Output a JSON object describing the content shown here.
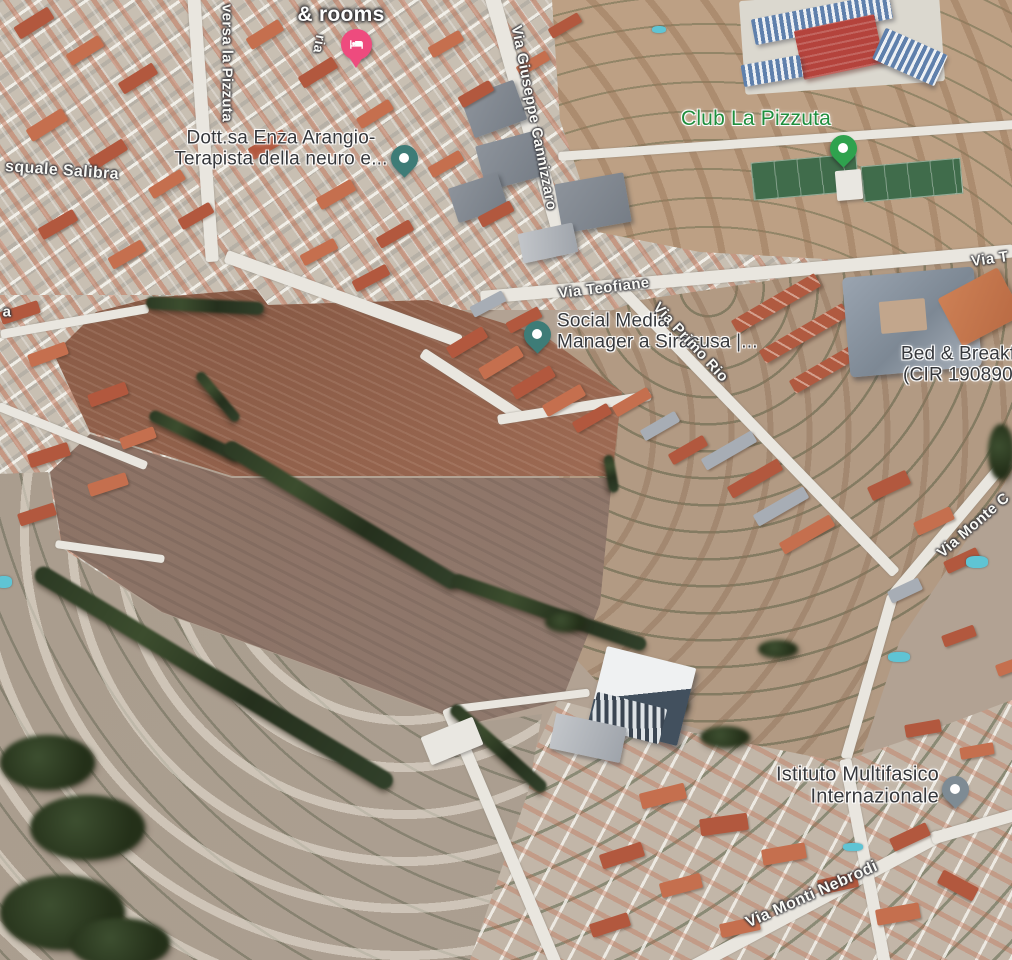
{
  "app": {
    "view": "satellite-map",
    "description": "Aerial 3D satellite map view of the La Pizzuta area, Siracusa"
  },
  "colors": {
    "street_label": "#fafaf6",
    "poi_label_dark": "#35373b",
    "poi_label_green": "#1f8e3d",
    "hotel_pin": "#ee4b7e",
    "teal_pin": "#3e7c77",
    "green_pin": "#2fa24e",
    "gray_pin": "#7e8b94"
  },
  "labels": [
    {
      "id": "hotel-rooms-label",
      "text": "& rooms",
      "style": "hotel",
      "x": 341,
      "y": 15,
      "rot": 0,
      "size": 21,
      "align": "center",
      "interactable": true
    },
    {
      "id": "street-ria",
      "text": "ria",
      "style": "street",
      "x": 319,
      "y": 44,
      "rot": 100,
      "size": 14,
      "align": "center",
      "interactable": false
    },
    {
      "id": "street-traversa-la-pizzuta",
      "text": "versa la Pizzuta",
      "style": "street",
      "x": 226,
      "y": 63,
      "rot": 90,
      "size": 15,
      "align": "center",
      "interactable": false
    },
    {
      "id": "street-pasquale-salibra",
      "text": "squale Salibra",
      "style": "street",
      "x": 62,
      "y": 171,
      "rot": 4,
      "size": 16,
      "align": "center",
      "interactable": false
    },
    {
      "id": "poi-dott-enza-arangio",
      "text": "Dott.sa Enza Arangio-\nTerapista della neuro e...",
      "style": "poi",
      "x": 281,
      "y": 149,
      "rot": 0,
      "size": 19,
      "align": "center",
      "interactable": true
    },
    {
      "id": "street-via-giuseppe-cannizzaro",
      "text": "Via Giuseppe Cannizzaro",
      "style": "street",
      "x": 533,
      "y": 118,
      "rot": 79,
      "size": 15,
      "align": "center",
      "interactable": false
    },
    {
      "id": "poi-club-la-pizzuta",
      "text": "Club La Pizzuta",
      "style": "poi-green",
      "x": 756,
      "y": 119,
      "rot": 0,
      "size": 21,
      "align": "center",
      "interactable": true
    },
    {
      "id": "street-via-t",
      "text": "Via T",
      "style": "street",
      "x": 990,
      "y": 260,
      "rot": -8,
      "size": 15,
      "align": "center",
      "interactable": false
    },
    {
      "id": "street-via-teofiane",
      "text": "Via Teofiane",
      "style": "street",
      "x": 604,
      "y": 289,
      "rot": -7,
      "size": 15,
      "align": "center",
      "interactable": false
    },
    {
      "id": "poi-social-media-manager",
      "text": "Social Media\nManager a Siracusa |...",
      "style": "poi",
      "x": 557,
      "y": 332,
      "rot": 0,
      "size": 19,
      "align": "left",
      "interactable": true
    },
    {
      "id": "street-via-primo-rio",
      "text": "Via Primo Rio",
      "style": "street",
      "x": 690,
      "y": 343,
      "rot": 47,
      "size": 15,
      "align": "center",
      "interactable": false
    },
    {
      "id": "poi-bed-and-breakfast",
      "text": "Bed & Breakf\n(CIR 190890",
      "style": "poi",
      "x": 958,
      "y": 365,
      "rot": 0,
      "size": 19,
      "align": "center",
      "interactable": true
    },
    {
      "id": "street-via-monte-c",
      "text": "Via Monte C",
      "style": "street",
      "x": 974,
      "y": 526,
      "rot": -41,
      "size": 15,
      "align": "center",
      "interactable": false
    },
    {
      "id": "poi-istituto-multifasico",
      "text": "Istituto Multifasico\nInternazionale",
      "style": "poi",
      "x": 939,
      "y": 786,
      "rot": 0,
      "size": 20,
      "align": "right",
      "interactable": true
    },
    {
      "id": "street-via-monti-nebrodi",
      "text": "Via Monti Nebrodi",
      "style": "street",
      "x": 812,
      "y": 895,
      "rot": -24,
      "size": 16,
      "align": "center",
      "interactable": false
    },
    {
      "id": "street-partial-a",
      "text": "a",
      "style": "street",
      "x": 7,
      "y": 313,
      "rot": 0,
      "size": 15,
      "align": "center",
      "interactable": false
    }
  ],
  "pins": [
    {
      "id": "hotel-pin",
      "kind": "hotel",
      "icon": "bed-icon",
      "color": "#ee4b7e",
      "tip_x": 356,
      "tip_y": 68
    },
    {
      "id": "dott-enza-arangio-pin",
      "kind": "teardrop",
      "icon": "dot",
      "color": "#3e7c77",
      "tip_x": 404,
      "tip_y": 177
    },
    {
      "id": "club-la-pizzuta-pin",
      "kind": "teardrop",
      "icon": "dot",
      "color": "#2fa24e",
      "tip_x": 843,
      "tip_y": 167
    },
    {
      "id": "social-media-manager-pin",
      "kind": "teardrop",
      "icon": "dot",
      "color": "#3e7c77",
      "tip_x": 537,
      "tip_y": 353
    },
    {
      "id": "istituto-multifasico-pin",
      "kind": "teardrop",
      "icon": "dot",
      "color": "#7e8b94",
      "tip_x": 955,
      "tip_y": 808
    }
  ]
}
